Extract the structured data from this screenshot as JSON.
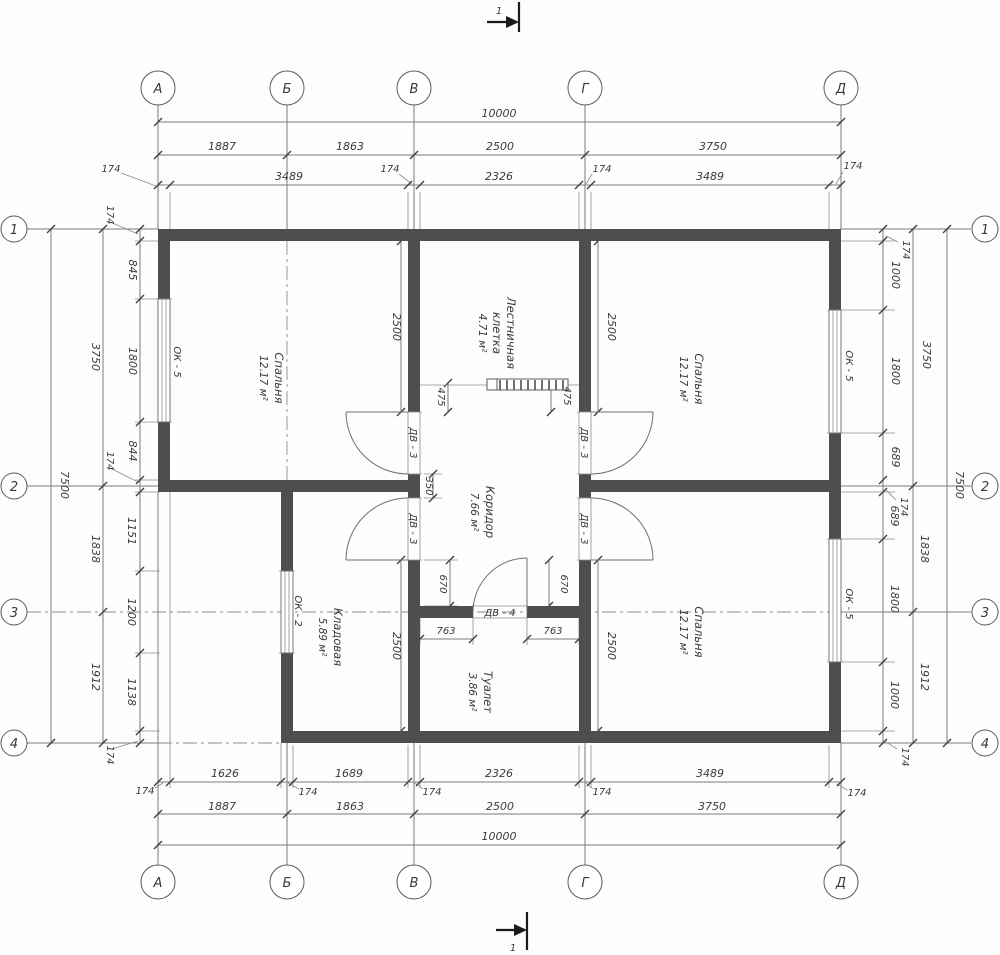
{
  "section": {
    "number": "1"
  },
  "axes": {
    "columns": [
      "А",
      "Б",
      "В",
      "Г",
      "Д"
    ],
    "rows": [
      "1",
      "2",
      "3",
      "4"
    ]
  },
  "rooms": {
    "bedroom_tl": {
      "name": "Спальня",
      "area": "12.17 м²"
    },
    "bedroom_tr": {
      "name": "Спальня",
      "area": "12.17 м²"
    },
    "bedroom_br": {
      "name": "Спальня",
      "area": "12.17 м²"
    },
    "staircase": {
      "name_line1": "Лестничная",
      "name_line2": "клетка",
      "area": "4.71 м²"
    },
    "corridor": {
      "name": "Коридор",
      "area": "7.66 м²"
    },
    "storage": {
      "name": "Кладовая",
      "area": "5.89 м²"
    },
    "toilet": {
      "name": "Туалет",
      "area": "3.86 м²"
    }
  },
  "doors": {
    "dv3": "ДВ - 3",
    "dv4": "ДВ - 4"
  },
  "windows": {
    "ok5": "ОК - 5",
    "ok2": "ОК - 2"
  },
  "dims": {
    "overall_width": "10000",
    "overall_height": "7500",
    "top": {
      "spans": [
        "1887",
        "1863",
        "2500",
        "3750"
      ],
      "inner": [
        "3489",
        "2326",
        "3489"
      ]
    },
    "bottom": {
      "inner": [
        "1626",
        "1689",
        "2326",
        "3489"
      ],
      "spans": [
        "1887",
        "1863",
        "2500",
        "3750"
      ]
    },
    "left": {
      "inner": [
        "845",
        "1800",
        "844",
        "1151",
        "1200",
        "1138"
      ],
      "mid": [
        "3750",
        "1838",
        "1912"
      ]
    },
    "right": {
      "inner": [
        "1000",
        "1800",
        "689",
        "689",
        "1800",
        "1000"
      ],
      "mid": [
        "3750",
        "1838",
        "1912"
      ]
    },
    "wall_thickness": "174",
    "stair_offset": "475",
    "corridor_gap": "350",
    "door_offset": "670",
    "toilet_door_offset": "763",
    "room_depth": "2500"
  },
  "colors": {
    "wall": "#4e4e4e",
    "line": "#7a7a7a",
    "text": "#3a3a3a"
  }
}
